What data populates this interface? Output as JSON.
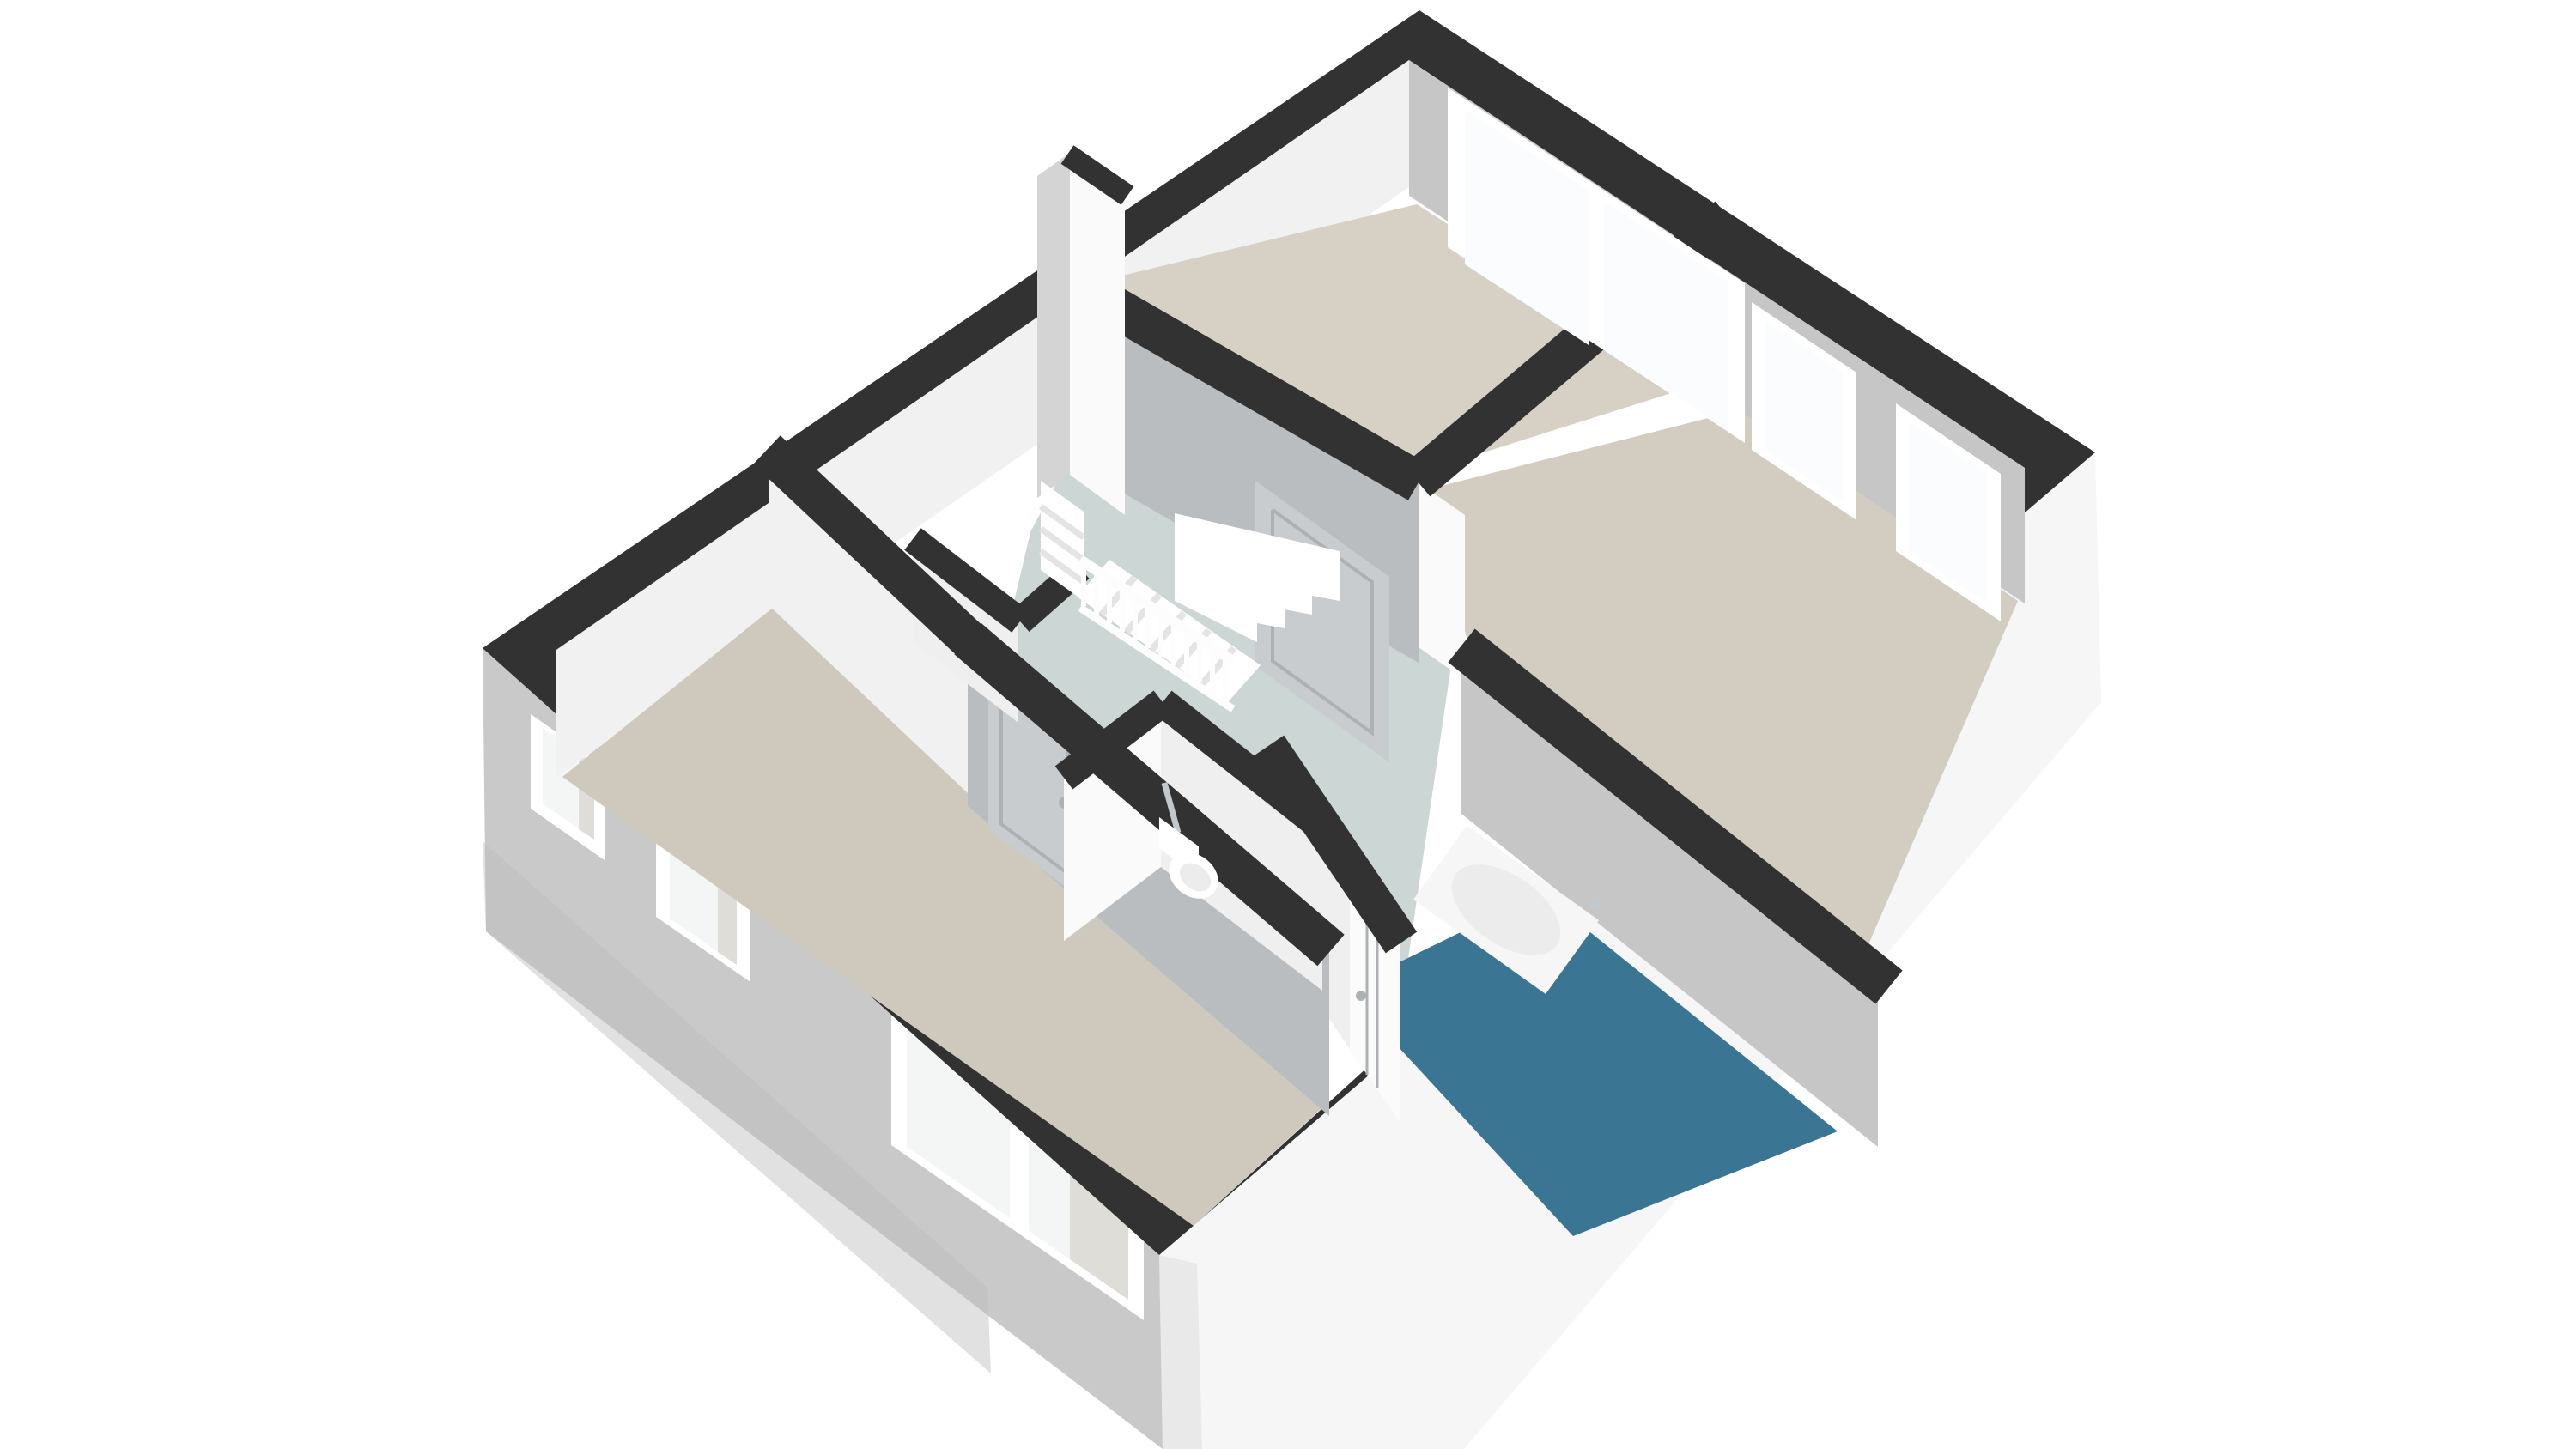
{
  "scene": {
    "type": "3d-floor-plan-render",
    "view": "isometric-top-down",
    "floor_label": "",
    "rooms": [
      {
        "id": "bedroom-top",
        "floor": "beige"
      },
      {
        "id": "bedroom-right",
        "floor": "beige"
      },
      {
        "id": "bedroom-left",
        "floor": "beige"
      },
      {
        "id": "bathroom",
        "floor": "teal-blue"
      },
      {
        "id": "wc",
        "floor": "pale-gray"
      },
      {
        "id": "landing",
        "floor": "pale-gray-green"
      }
    ],
    "fixtures": [
      "bathtub",
      "wall-hung-toilet",
      "staircase",
      "stair-balustrade"
    ],
    "window_count": 6,
    "door_count": 4
  },
  "colors": {
    "background": "#ffffff",
    "wallCap": "#323232",
    "innerBase": "#ffffff",
    "extLeft": "#c9c9c9",
    "extLeftShade": "#bcbcbc",
    "extRight": "#f6f6f6",
    "extRightShade": "#e9e9e9",
    "faceLight": "#f1f1f1",
    "faceDark": "#c6c6c6",
    "faceMid": "#b9bdbf",
    "faceSoft": "#efefef",
    "faceWhite": "#fafafa",
    "slabSide": "#d4d4d4",
    "floorTop": "#d6d0c5",
    "floorRight": "#d2ccc1",
    "floorLeft": "#cfc9bd",
    "floorHall": "#ccd6d4",
    "floorWc": "#cdd6d4",
    "floorBath": "#3a7593",
    "windowFrame": "#ffffff",
    "glass": "#fbfcfd",
    "glassSoft": "#f4f5f5",
    "recess": "#dfddd8",
    "doorGray": "#c9ccce",
    "doorSeam": "#aeb1b3",
    "doorWhite": "#fbfbfb",
    "tub": "#f6f6f6",
    "tubInner": "#ececec",
    "toilet": "#ffffff",
    "chrome": "#c2c8cc",
    "stair": "#ffffff",
    "stairShade": "#e4e4e4",
    "railing": "#fdfdfd",
    "shadow": "#e8e8e8"
  }
}
